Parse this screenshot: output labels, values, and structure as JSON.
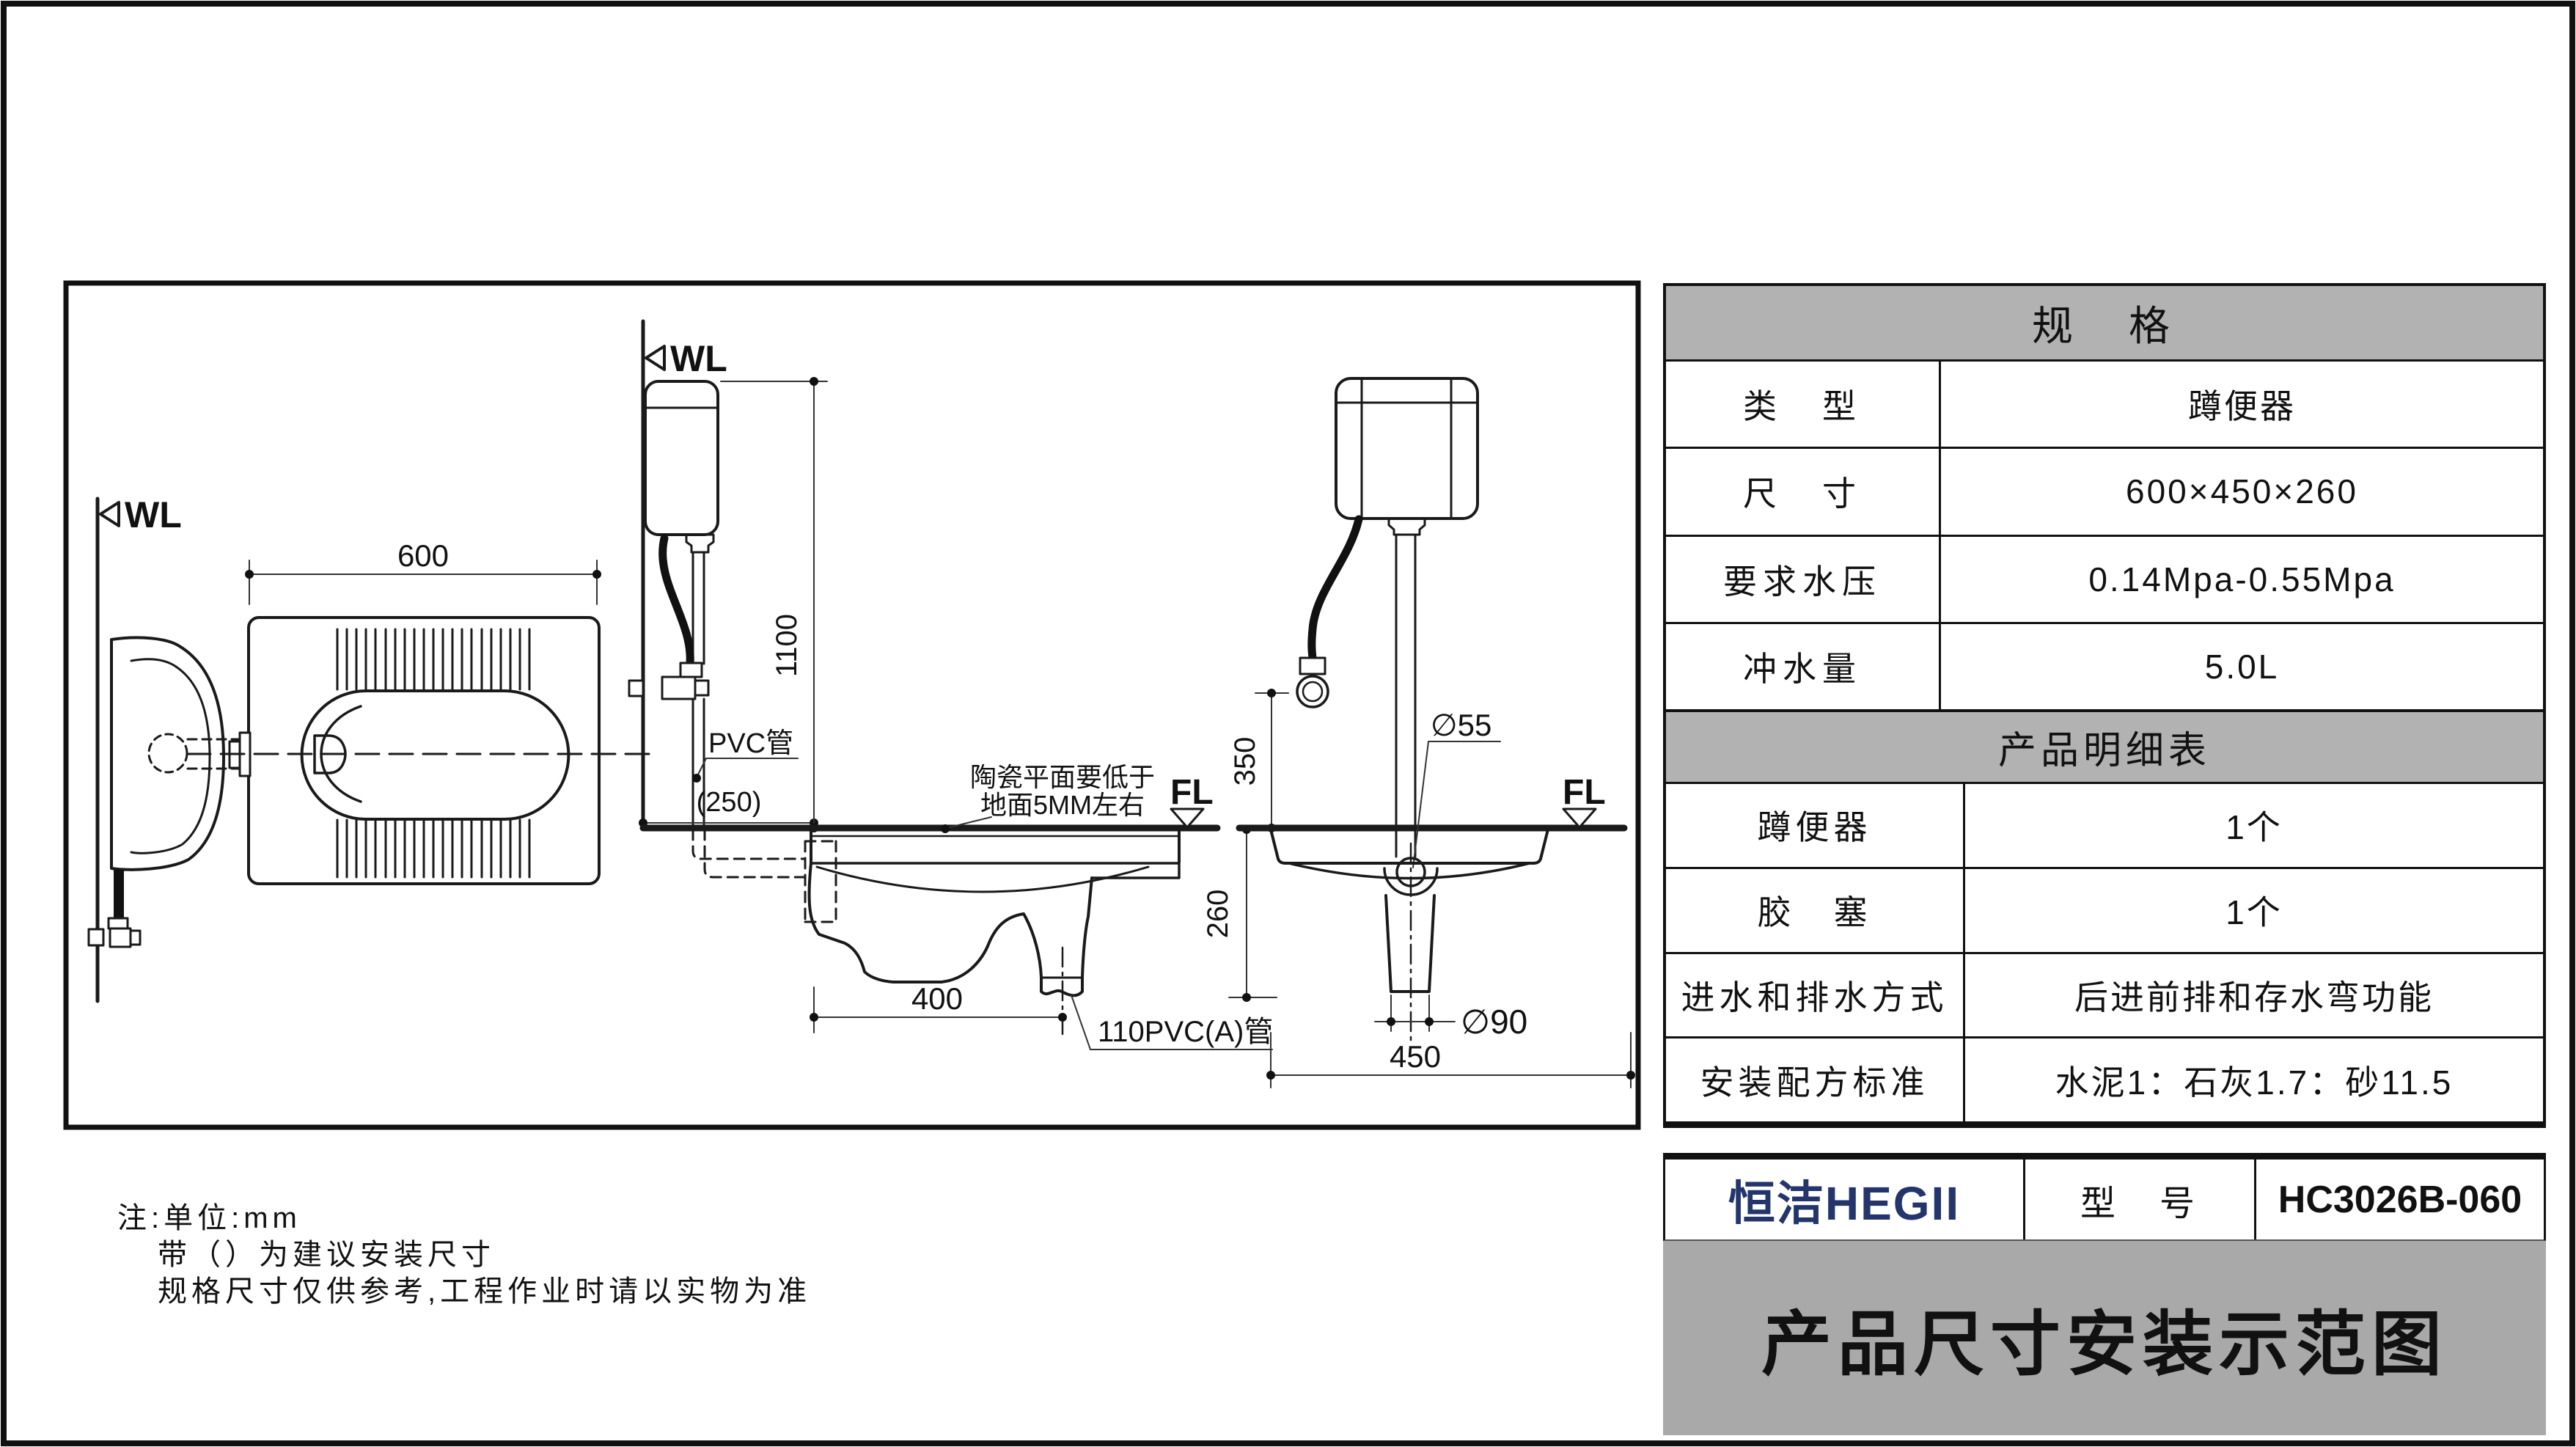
{
  "page": {
    "colors": {
      "brand_navy": "#24356b",
      "table_header_gray": "#b2b2b2",
      "title_bar_gray": "#a9a9a9",
      "line_black": "#111111"
    }
  },
  "drawing": {
    "wall_label": "WL",
    "floor_label": "FL",
    "top_view": {
      "width_dim": "600"
    },
    "side_view": {
      "height_dim": "1100",
      "wall_offset_dim": "(250)",
      "pipe_label": "PVC管",
      "ceramic_note_line1": "陶瓷平面要低于",
      "ceramic_note_line2": "地面5MM左右",
      "outlet_offset_dim": "400",
      "drain_pipe_label": "110PVC(A)管",
      "depth_dim": "260"
    },
    "front_view": {
      "inlet_height_dim": "350",
      "spud_dia": "∅55",
      "outlet_dia": "∅90",
      "width_dim": "450"
    }
  },
  "spec_table": {
    "title": "规　格",
    "rows": [
      {
        "label": "类　型",
        "value": "蹲便器"
      },
      {
        "label": "尺　寸",
        "value": "600×450×260"
      },
      {
        "label": "要求水压",
        "value": "0.14Mpa-0.55Mpa"
      },
      {
        "label": "冲水量",
        "value": "5.0L"
      }
    ]
  },
  "parts_table": {
    "title": "产品明细表",
    "rows": [
      {
        "label": "蹲便器",
        "value": "1个"
      },
      {
        "label": "胶　塞",
        "value": "1个"
      },
      {
        "label": "进水和排水方式",
        "value": "后进前排和存水弯功能"
      },
      {
        "label": "安装配方标准",
        "value": "水泥1：石灰1.7：砂11.5"
      }
    ]
  },
  "title_block": {
    "brand": "恒洁HEGII",
    "model_label": "型　号",
    "model_value": "HC3026B-060",
    "title": "产品尺寸安装示范图"
  },
  "notes": {
    "line1": "注:单位:mm",
    "line2": "带（）为建议安装尺寸",
    "line3": "规格尺寸仅供参考,工程作业时请以实物为准"
  }
}
